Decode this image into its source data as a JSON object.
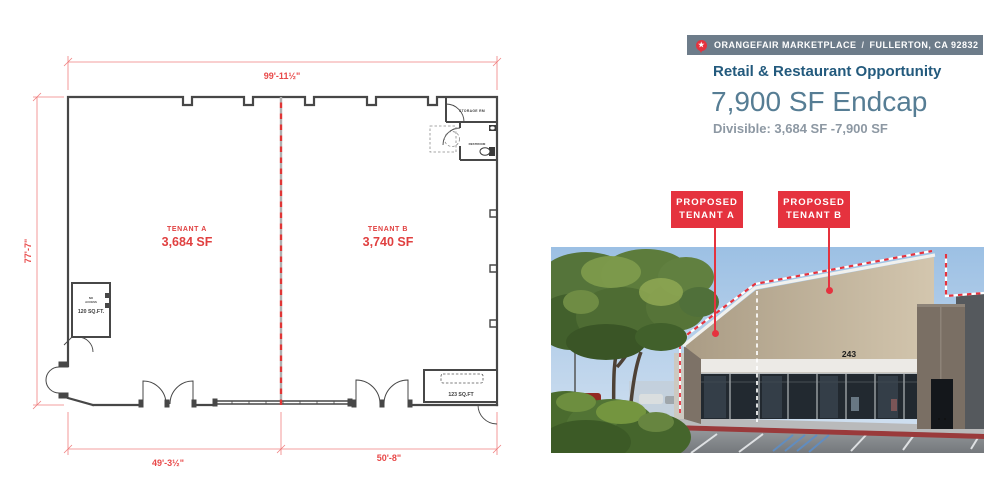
{
  "plan": {
    "dims": {
      "top": "99'-11½\"",
      "left": "77'-7\"",
      "bottom_left": "49'-3½\"",
      "bottom_right": "50'-8\""
    },
    "tenant_a_name": "TENANT A",
    "tenant_a_area": "3,684 SF",
    "tenant_b_name": "TENANT B",
    "tenant_b_area": "3,740 SF",
    "storage_room": "STORAGE RM",
    "restroom": "RESTROOM",
    "no_access_1": "NO",
    "no_access_2": "ACCESS",
    "room_120": "120 SQ.FT.",
    "room_123": "123 SQ.FT"
  },
  "header": {
    "property_name": "ORANGEFAIR MARKETPLACE",
    "divider": "/",
    "address": "FULLERTON, CA 92832",
    "pin_icon": "map-pin-star"
  },
  "intro": {
    "subtitle": "Retail & Restaurant Opportunity",
    "headline": "7,900 SF Endcap",
    "divisible": "Divisible: 3,684 SF -7,900 SF"
  },
  "callouts": {
    "tenant_a_line1": "PROPOSED",
    "tenant_a_line2": "TENANT A",
    "tenant_b_line1": "PROPOSED",
    "tenant_b_line2": "TENANT B"
  },
  "photo": {
    "address_number": "243"
  },
  "colors": {
    "accent_red": "#e5323e",
    "plan_red": "#e84848",
    "header_bar": "#6d7c8a",
    "title_dark": "#235a7d",
    "title_light": "#567d94",
    "muted_gray": "#8d98a3",
    "wall_gray": "#474747"
  }
}
